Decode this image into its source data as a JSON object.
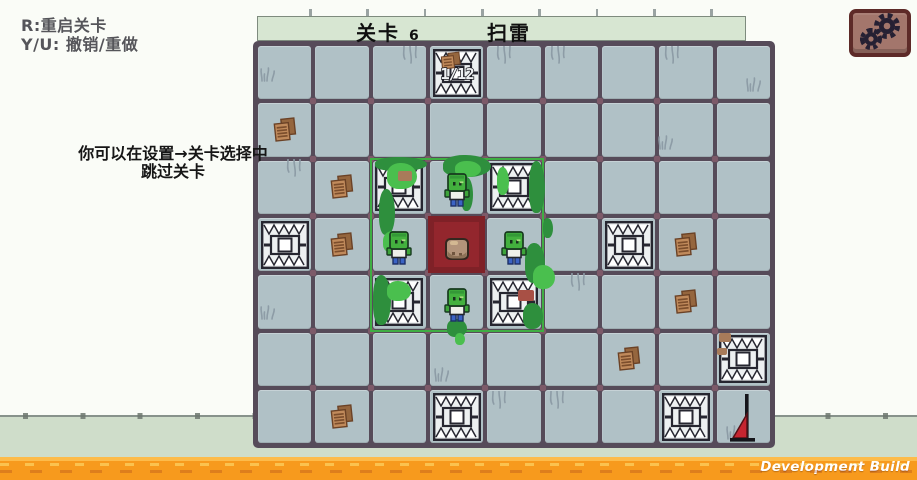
{
  "colors": {
    "background": "#fafcf7",
    "floor": "#cfddca",
    "board_line": "#564b59",
    "tile": "#b0c1c6",
    "corner_dot": "#7d5a69",
    "title_bar_bg": "#d7e6d2",
    "highlight_green": "#3fae43",
    "moss_dark": "#2e8f3d",
    "moss_light": "#4abf4e",
    "red_tile": "#7f2127",
    "red_tile_inner": "#93262d",
    "orange_bar": "#f79a1d",
    "orange_bar_light": "#fdbb4a",
    "button_bg": "#a3766c",
    "button_border": "#5d2a28",
    "gear": "#262033",
    "text_dark": "#55555a",
    "text_black": "#161616"
  },
  "hud": {
    "restart_hint": "R:重启关卡",
    "undo_hint": "Y/U: 撤销/重做",
    "tip_line1": "你可以在设置→关卡选择中",
    "tip_line2": "跳过关卡"
  },
  "title_bar": {
    "level_label": "关卡",
    "level_number": "6",
    "level_name": "扫雷"
  },
  "board": {
    "cols": 9,
    "rows": 7,
    "counter_tile": {
      "row": 0,
      "col": 3,
      "label": "1/12"
    },
    "traps": [
      {
        "row": 3,
        "col": 0
      },
      {
        "row": 3,
        "col": 6
      },
      {
        "row": 5,
        "col": 8
      },
      {
        "row": 6,
        "col": 3
      },
      {
        "row": 6,
        "col": 7
      }
    ],
    "vine_traps": [
      {
        "row": 2,
        "col": 2
      },
      {
        "row": 2,
        "col": 4
      },
      {
        "row": 4,
        "col": 2
      },
      {
        "row": 4,
        "col": 4
      }
    ],
    "zombies": [
      {
        "row": 2,
        "col": 3
      },
      {
        "row": 3,
        "col": 2
      },
      {
        "row": 3,
        "col": 4
      },
      {
        "row": 4,
        "col": 3
      }
    ],
    "rock_tile": {
      "row": 3,
      "col": 3
    },
    "leaf_piles": [
      {
        "row": 1,
        "col": 0
      },
      {
        "row": 2,
        "col": 1
      },
      {
        "row": 3,
        "col": 1
      },
      {
        "row": 3,
        "col": 7
      },
      {
        "row": 4,
        "col": 7
      },
      {
        "row": 5,
        "col": 6
      },
      {
        "row": 6,
        "col": 1
      }
    ],
    "flag": {
      "row": 6,
      "col": 8
    },
    "highlight": {
      "row": 2,
      "col": 2,
      "span": 3
    },
    "moss": [
      [
        119,
        113,
        52,
        14,
        0
      ],
      [
        131,
        119,
        30,
        26,
        1
      ],
      [
        123,
        145,
        16,
        46,
        0
      ],
      [
        127,
        187,
        22,
        22,
        1
      ],
      [
        117,
        231,
        18,
        50,
        0
      ],
      [
        131,
        237,
        24,
        20,
        1
      ],
      [
        187,
        111,
        48,
        22,
        0
      ],
      [
        199,
        117,
        26,
        16,
        1
      ],
      [
        205,
        133,
        12,
        34,
        0
      ],
      [
        273,
        117,
        16,
        52,
        0
      ],
      [
        241,
        123,
        12,
        28,
        1
      ],
      [
        287,
        174,
        10,
        20,
        0
      ],
      [
        269,
        199,
        20,
        40,
        0
      ],
      [
        277,
        221,
        22,
        24,
        1
      ],
      [
        267,
        259,
        20,
        26,
        0
      ],
      [
        191,
        275,
        20,
        18,
        0
      ],
      [
        199,
        289,
        10,
        12,
        1
      ]
    ],
    "accents": [
      [
        142,
        127,
        14,
        10,
        "#a87b5a"
      ],
      [
        262,
        246,
        16,
        11,
        "#a85045"
      ],
      [
        463,
        289,
        12,
        9,
        "#a87b5a"
      ],
      [
        461,
        304,
        10,
        7,
        "#a87b5a"
      ]
    ],
    "decorations": {
      "grass": [
        [
          3,
          21
        ],
        [
          489,
          31
        ],
        [
          401,
          89
        ],
        [
          3,
          259
        ],
        [
          177,
          321
        ],
        [
          469,
          379
        ]
      ],
      "vine": [
        [
          145,
          2
        ],
        [
          239,
          2
        ],
        [
          293,
          2
        ],
        [
          407,
          2
        ],
        [
          29,
          115
        ],
        [
          313,
          229
        ],
        [
          234,
          347
        ],
        [
          292,
          347
        ]
      ]
    }
  },
  "footer": {
    "dev_build_label": "Development Build"
  }
}
